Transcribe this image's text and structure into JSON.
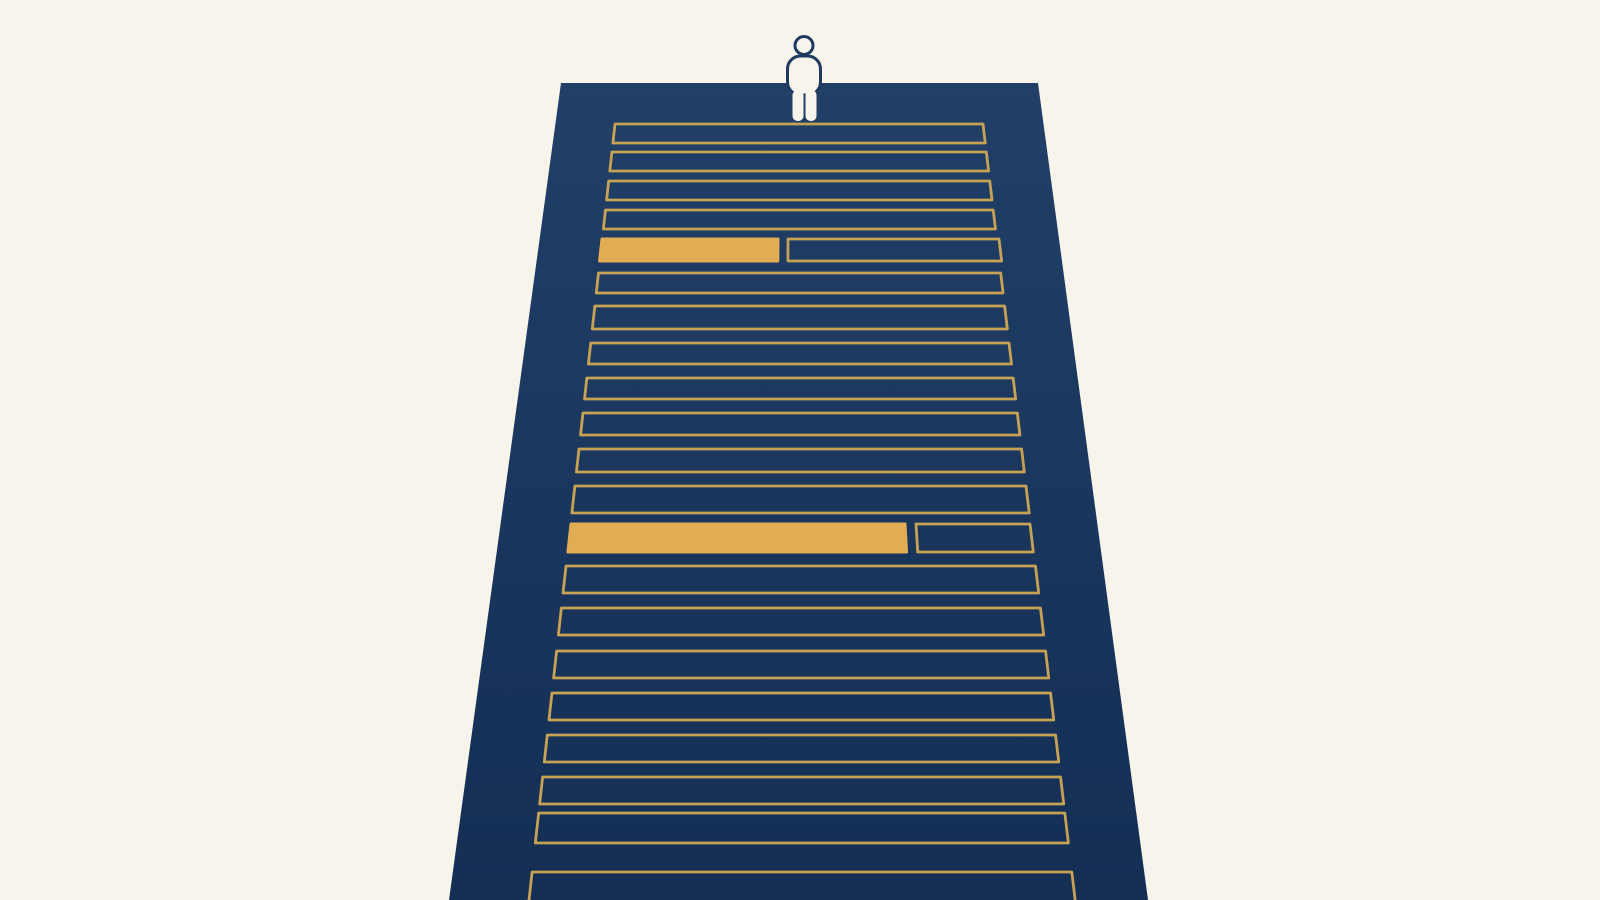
{
  "colors": {
    "background": "#f7f4ec",
    "cream": "#f7f4ec",
    "navy_top": "#213f67",
    "navy_bottom": "#142e54",
    "navy_outline": "#1e3a5f",
    "gold_fill": "#e2ac53",
    "gold_outline": "#c6a254"
  },
  "illustration": {
    "tower": {
      "top_y": 83,
      "top_left_x": 561,
      "top_right_x": 1038,
      "bottom_y": 900,
      "bottom_left_x": 449,
      "bottom_right_x": 1148
    },
    "rung_frame": {
      "top_y": 124,
      "bottom_y": 882,
      "left_top_x": 615,
      "left_bottom_x": 531,
      "right_top_x": 983,
      "right_bottom_x": 1073,
      "outline_width": 2.8,
      "fill_stroke_width": 3
    },
    "rungs": [
      {
        "y": 124,
        "h": 19
      },
      {
        "y": 152,
        "h": 19
      },
      {
        "y": 181,
        "h": 19
      },
      {
        "y": 210,
        "h": 19
      },
      {
        "y": 239,
        "h": 22,
        "segments": [
          {
            "kind": "gold",
            "x1": 602,
            "x2": 778
          },
          {
            "kind": "outline",
            "x1": 788,
            "x2": 999
          }
        ]
      },
      {
        "y": 273,
        "h": 20
      },
      {
        "y": 306,
        "h": 23
      },
      {
        "y": 343,
        "h": 21
      },
      {
        "y": 378,
        "h": 21
      },
      {
        "y": 413,
        "h": 22
      },
      {
        "y": 449,
        "h": 23
      },
      {
        "y": 486,
        "h": 27
      },
      {
        "y": 524,
        "h": 28,
        "segments": [
          {
            "kind": "gold",
            "x1": 571,
            "x2": 905
          },
          {
            "kind": "outline",
            "x1": 916,
            "x2": 1030
          }
        ]
      },
      {
        "y": 566,
        "h": 27
      },
      {
        "y": 608,
        "h": 27
      },
      {
        "y": 651,
        "h": 27
      },
      {
        "y": 693,
        "h": 27
      },
      {
        "y": 735,
        "h": 27
      },
      {
        "y": 777,
        "h": 27
      },
      {
        "y": 813,
        "h": 30
      },
      {
        "y": 872,
        "h": 34
      }
    ],
    "person": {
      "head": {
        "cx": 804,
        "cy": 45.5,
        "r": 9,
        "stroke_w": 3
      },
      "torso": {
        "x": 787.5,
        "y": 56,
        "w": 33,
        "h": 39,
        "rx": 13,
        "stroke_w": 3
      },
      "legs": [
        {
          "x": 792.5,
          "y": 90,
          "w": 11,
          "h": 31,
          "rx": 5
        },
        {
          "x": 805.5,
          "y": 90,
          "w": 11,
          "h": 31,
          "rx": 5
        }
      ]
    }
  }
}
